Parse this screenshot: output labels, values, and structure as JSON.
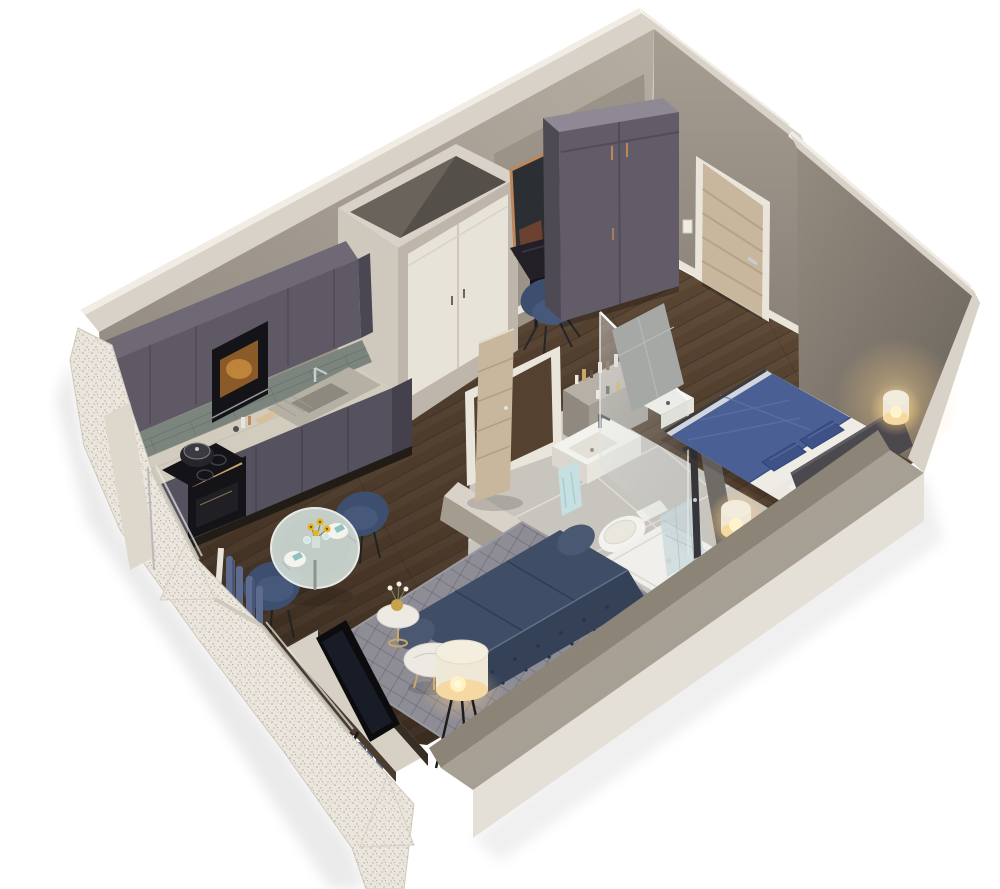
{
  "page": {
    "title": "Isometric 3D cutaway floor plan render of a studio apartment",
    "background": "#ffffff"
  },
  "colors": {
    "wall_cut": "#d9d2c8",
    "wall_sliver": "#f1ede5",
    "wall_face": "#b6ada1",
    "entry_wall_face": "#a79e92",
    "niche_panel": "#9b9288",
    "right_wall": "#958c80",
    "front_wall_inner": "#8d8478",
    "front_wall_top": "#b2aa9e",
    "front_wall_outer": "#e5e0d7",
    "skirting": "#eae5db",
    "floor_wood": "#4c3a2b",
    "bath_floor": "#c8c4be",
    "shower_tray": "#f1efeb",
    "fixture_white": "#f4f2ec",
    "towel_blue": "#c6dfe1",
    "tile_wall": "#a6a8a6",
    "glass_tint": "#ccd9dc",
    "cabinet": "#5e5965",
    "cabinet_dark": "#56515f",
    "cabinet_top": "#6e6975",
    "backsplash": "#7b857e",
    "counter": "#d2ccbe",
    "appliance_black": "#141418",
    "gold": "#c9a76b",
    "steel": "#b5b0a4",
    "closet_face_light": "#cfc8bc",
    "closet_face_shade": "#beb6aa",
    "closet_door": "#e8e3d9",
    "closet_cavity": "#6a635b",
    "door_frame": "#eae5db",
    "door_oak": "#c9b79d",
    "wardrobe_top": "#8e8994",
    "wardrobe_side": "#4e4a54",
    "wardrobe_face": "#615c67",
    "desk_top": "#221f26",
    "chair_navy": "#47597b",
    "chair_navy_dark": "#3d4e6e",
    "mirror_copper": "#bf8659",
    "rug": "#8e8d96",
    "sofa": "#3f4e66",
    "sofa_dark": "#344156",
    "glass_table": "#ccd7d1",
    "marble": "#edeae4",
    "lamp_shade": "#efe8d7",
    "lamp_warm": "#f6d9a2",
    "tv_black": "#0c0c0e",
    "console_top": "#d7d1c5",
    "console_dark": "#362d24",
    "curtain_blue": "#5c6b8e",
    "curtain_white": "#e7e3da",
    "bed_sheet": "#ece9e2",
    "bed_duvet": "#4a5f94",
    "bed_pillow": "#3e5288",
    "headboard": "#4b484e",
    "exterior_cut": "#eae6dd",
    "sunflower": "#e6b41f",
    "teal_napkin": "#8fc3bc"
  },
  "scene": {
    "type": "3d-floor-plan",
    "view": "isometric cutaway from above",
    "rooms": [
      {
        "name": "kitchen",
        "items": [
          "upper-cabinets",
          "microwave",
          "glass-tile-backsplash",
          "marble-countertop",
          "cooktop-with-pot",
          "oven-gold-handle",
          "stainless-sink",
          "base-cabinets",
          "counter-bottles",
          "cutting-board"
        ]
      },
      {
        "name": "hall",
        "items": [
          "storage-closet-white-double-doors",
          "desk",
          "copper-mirror",
          "decor-box",
          "desk-chair",
          "wardrobe",
          "entrance-door",
          "light-switch"
        ]
      },
      {
        "name": "bathroom",
        "items": [
          "open-oak-door",
          "white-door-frame",
          "vanity-shelf-bottles",
          "washbasin",
          "hand-towel",
          "second-basin",
          "toilet",
          "shower-tray",
          "glass-shower-screen",
          "shower-column",
          "tiled-wall"
        ]
      },
      {
        "name": "bedroom",
        "items": [
          "double-bed-blue-duvet",
          "navy-pillows",
          "white-pillows",
          "dark-headboard",
          "glowing-bedside-lamp-left",
          "glowing-bedside-lamp-right",
          "warm-wall-glow"
        ]
      },
      {
        "name": "living-dining",
        "items": [
          "round-glass-dining-table",
          "sunflower-centerpiece",
          "two-place-settings",
          "two-navy-dining-chairs",
          "navy-chesterfield-sofa",
          "diamond-pattern-rug",
          "marble-coffee-table",
          "marble-side-table-with-vase",
          "tripod-floor-lamp",
          "tv",
          "media-console",
          "blue-curtains",
          "white-curtains"
        ]
      },
      {
        "name": "exterior",
        "items": [
          "speckled-cut-walls",
          "window-wall-peaks",
          "window-frames"
        ]
      }
    ]
  }
}
